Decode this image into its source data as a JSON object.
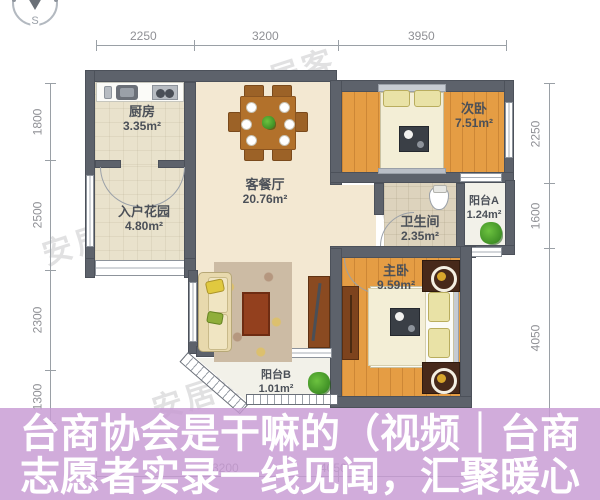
{
  "compass": {
    "south_label": "S"
  },
  "watermark": {
    "text": "安居客"
  },
  "dimensions": {
    "top": [
      "2250",
      "3200",
      "3950"
    ],
    "left": [
      "1800",
      "2500",
      "2300",
      "1300"
    ],
    "right": [
      "2250",
      "1600",
      "4050"
    ],
    "bottom": [
      "3200",
      "4050"
    ]
  },
  "rooms": {
    "kitchen": {
      "name": "厨房",
      "area": "3.35m²"
    },
    "entrance_garden": {
      "name": "入户花园",
      "area": "4.80m²"
    },
    "living_dining": {
      "name": "客餐厅",
      "area": "20.76m²"
    },
    "second_bedroom": {
      "name": "次卧",
      "area": "7.51m²"
    },
    "bathroom": {
      "name": "卫生间",
      "area": "2.35m²"
    },
    "balcony_a": {
      "name": "阳台A",
      "area": "1.24m²"
    },
    "master_bedroom": {
      "name": "主卧",
      "area": "9.59m²"
    },
    "balcony_b": {
      "name": "阳台B",
      "area": "1.01m²"
    }
  },
  "overlay": {
    "title_line1": "台商协会是干嘛的（视频｜台商",
    "title_line2": "志愿者实录一线见闻，汇聚暖心",
    "background_color": "#c79ad3",
    "text_color": "#ffffff"
  },
  "colors": {
    "wall": "#5d626b",
    "wood_floor": "#e59d44",
    "beige_floor": "#f3e8d2",
    "dimension_text": "#8f9095"
  }
}
